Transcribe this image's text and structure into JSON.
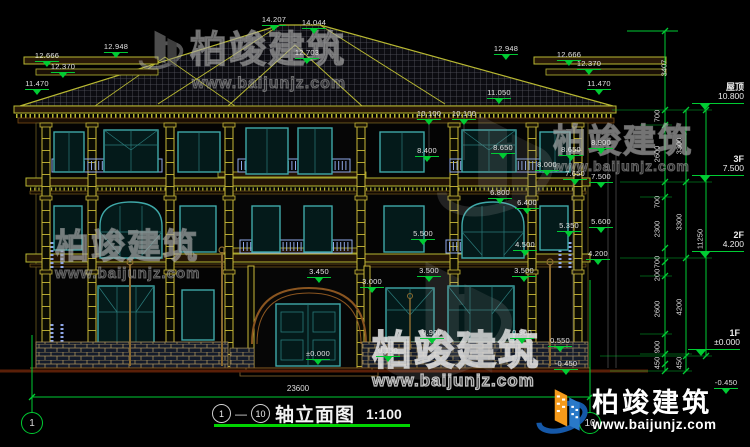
{
  "drawing": {
    "axis_start": "1",
    "axis_end": "10",
    "title_dash": "—",
    "title": "轴立面图",
    "scale": "1:100",
    "total_width_dim": "23600"
  },
  "watermark": {
    "brand": "柏竣建筑",
    "url": "www.baijunjz.com"
  },
  "axis_bubbles": [
    {
      "label": "1",
      "x": 32,
      "y": 423
    },
    {
      "label": "10",
      "x": 590,
      "y": 423
    }
  ],
  "levels": [
    {
      "name": "屋顶",
      "elev": "10.800",
      "x": 688,
      "y": 82
    },
    {
      "name": "3F",
      "elev": "7.500",
      "x": 688,
      "y": 154
    },
    {
      "name": "2F",
      "elev": "4.200",
      "x": 688,
      "y": 230
    },
    {
      "name": "1F",
      "elev": "±0.000",
      "x": 684,
      "y": 328
    }
  ],
  "elevation_markers": [
    {
      "label": "12.948",
      "x": 116,
      "y": 43
    },
    {
      "label": "12.666",
      "x": 47,
      "y": 52
    },
    {
      "label": "12.370",
      "x": 63,
      "y": 63
    },
    {
      "label": "11.470",
      "x": 37,
      "y": 80
    },
    {
      "label": "14.207",
      "x": 274,
      "y": 16
    },
    {
      "label": "14.044",
      "x": 314,
      "y": 19
    },
    {
      "label": "12.703",
      "x": 307,
      "y": 49
    },
    {
      "label": "12.948",
      "x": 506,
      "y": 45
    },
    {
      "label": "12.666",
      "x": 569,
      "y": 51
    },
    {
      "label": "12.370",
      "x": 589,
      "y": 60
    },
    {
      "label": "11.470",
      "x": 599,
      "y": 80
    },
    {
      "label": "11.050",
      "x": 499,
      "y": 89
    },
    {
      "label": "10.100",
      "x": 429,
      "y": 110
    },
    {
      "label": "10.100",
      "x": 464,
      "y": 110
    },
    {
      "label": "8.900",
      "x": 601,
      "y": 139
    },
    {
      "label": "8.650",
      "x": 503,
      "y": 144
    },
    {
      "label": "8.650",
      "x": 571,
      "y": 146
    },
    {
      "label": "8.400",
      "x": 427,
      "y": 147
    },
    {
      "label": "8.000",
      "x": 547,
      "y": 161
    },
    {
      "label": "7.650",
      "x": 575,
      "y": 170
    },
    {
      "label": "7.500",
      "x": 601,
      "y": 173
    },
    {
      "label": "6.800",
      "x": 500,
      "y": 189
    },
    {
      "label": "6.400",
      "x": 527,
      "y": 199
    },
    {
      "label": "5.600",
      "x": 601,
      "y": 218
    },
    {
      "label": "5.500",
      "x": 423,
      "y": 230
    },
    {
      "label": "5.350",
      "x": 569,
      "y": 222
    },
    {
      "label": "4.500",
      "x": 525,
      "y": 241
    },
    {
      "label": "4.200",
      "x": 598,
      "y": 250
    },
    {
      "label": "3.500",
      "x": 429,
      "y": 267
    },
    {
      "label": "3.500",
      "x": 524,
      "y": 267
    },
    {
      "label": "3.450",
      "x": 319,
      "y": 268
    },
    {
      "label": "3.000",
      "x": 372,
      "y": 278
    },
    {
      "label": "0.900",
      "x": 432,
      "y": 329
    },
    {
      "label": "0.900",
      "x": 522,
      "y": 329
    },
    {
      "label": "0.550",
      "x": 560,
      "y": 337
    },
    {
      "label": "0.150",
      "x": 388,
      "y": 347
    },
    {
      "label": "±0.000",
      "x": 318,
      "y": 350
    },
    {
      "label": "-0.450",
      "x": 566,
      "y": 360
    },
    {
      "label": "-0.450",
      "x": 726,
      "y": 379
    }
  ],
  "dim_labels_vertical": [
    {
      "label": "3407",
      "x": 664,
      "y": 68
    },
    {
      "label": "700",
      "x": 657,
      "y": 116
    },
    {
      "label": "2600",
      "x": 657,
      "y": 154
    },
    {
      "label": "3300",
      "x": 679,
      "y": 146
    },
    {
      "label": "700",
      "x": 657,
      "y": 202
    },
    {
      "label": "2300",
      "x": 657,
      "y": 229
    },
    {
      "label": "3300",
      "x": 679,
      "y": 222
    },
    {
      "label": "11250",
      "x": 700,
      "y": 239
    },
    {
      "label": "700",
      "x": 657,
      "y": 262
    },
    {
      "label": "200",
      "x": 657,
      "y": 275
    },
    {
      "label": "2600",
      "x": 657,
      "y": 309
    },
    {
      "label": "4200",
      "x": 679,
      "y": 307
    },
    {
      "label": "900",
      "x": 657,
      "y": 347
    },
    {
      "label": "450",
      "x": 657,
      "y": 363
    },
    {
      "label": "450",
      "x": 679,
      "y": 363
    }
  ],
  "colors": {
    "line_yellow": "#b8b832",
    "dim_green": "#00cc33",
    "window_teal": "#3fa8a8",
    "balustrade_blue": "#8fa8e8",
    "ground_brown": "#5a1f08",
    "logo_blue": "#2979c8",
    "logo_orange": "#f59a1a"
  }
}
